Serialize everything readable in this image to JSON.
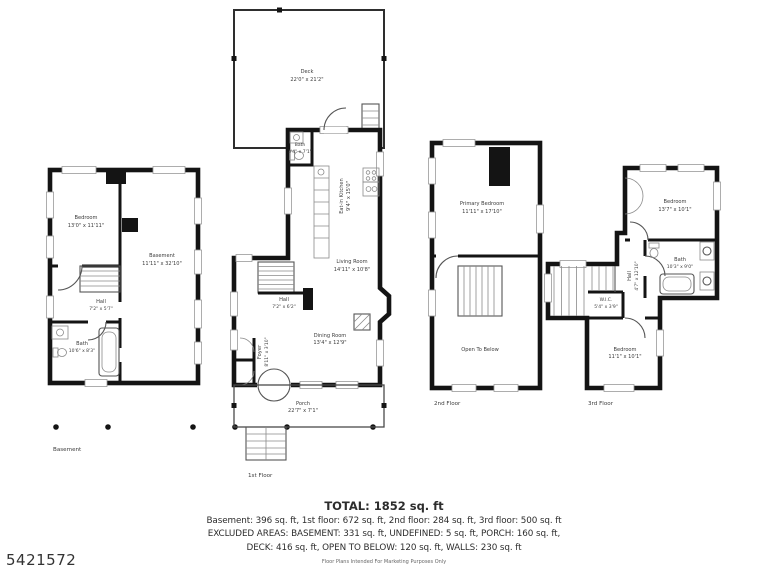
{
  "watermark": "5421572",
  "plans": {
    "basement": {
      "caption": "Basement",
      "rooms": [
        {
          "name": "Bedroom",
          "dims": "13'0\" x 11'11\""
        },
        {
          "name": "Basement",
          "dims": "11'11\" x 32'10\""
        },
        {
          "name": "Hall",
          "dims": "7'2\" x 5'7\""
        },
        {
          "name": "Bath",
          "dims": "10'6\" x 8'3\""
        }
      ]
    },
    "first_floor": {
      "caption": "1st Floor",
      "rooms": [
        {
          "name": "Deck",
          "dims": "22'0\" x 21'2\""
        },
        {
          "name": "Bath",
          "dims": "3'4\" x 7'1\""
        },
        {
          "name": "Eat-in Kitchen",
          "dims": "9'4\" x 15'0\""
        },
        {
          "name": "Living Room",
          "dims": "14'11\" x 10'8\""
        },
        {
          "name": "Hall",
          "dims": "7'2\" x 6'2\""
        },
        {
          "name": "Foyer",
          "dims": "8'11\" x 3'10\""
        },
        {
          "name": "Dining Room",
          "dims": "13'4\" x 12'9\""
        },
        {
          "name": "Porch",
          "dims": "22'7\" x 7'1\""
        }
      ]
    },
    "second_floor": {
      "caption": "2nd Floor",
      "rooms": [
        {
          "name": "Primary Bedroom",
          "dims": "11'11\" x 17'10\""
        },
        {
          "name": "Open To Below",
          "dims": ""
        }
      ]
    },
    "third_floor": {
      "caption": "3rd Floor",
      "rooms": [
        {
          "name": "Bedroom",
          "dims": "13'7\" x 10'1\""
        },
        {
          "name": "Bath",
          "dims": "10'3\" x 9'0\""
        },
        {
          "name": "Hall",
          "dims": "4'7\" x 12'10\""
        },
        {
          "name": "W.I.C.",
          "dims": "5'4\" x 3'9\""
        },
        {
          "name": "Bedroom",
          "dims": "11'1\" x 10'1\""
        }
      ]
    }
  },
  "summary": {
    "total": "TOTAL: 1852 sq. ft",
    "line1": "Basement: 396 sq. ft, 1st floor: 672 sq. ft, 2nd floor: 284 sq. ft, 3rd floor: 500 sq. ft",
    "line2": "EXCLUDED AREAS: BASEMENT: 331 sq. ft, UNDEFINED: 5 sq. ft, PORCH: 160 sq. ft,",
    "line3": "DECK: 416 sq. ft, OPEN TO BELOW: 120 sq. ft, WALLS: 230 sq. ft",
    "disclaimer": "Floor Plans Intended For Marketing Purposes Only"
  }
}
